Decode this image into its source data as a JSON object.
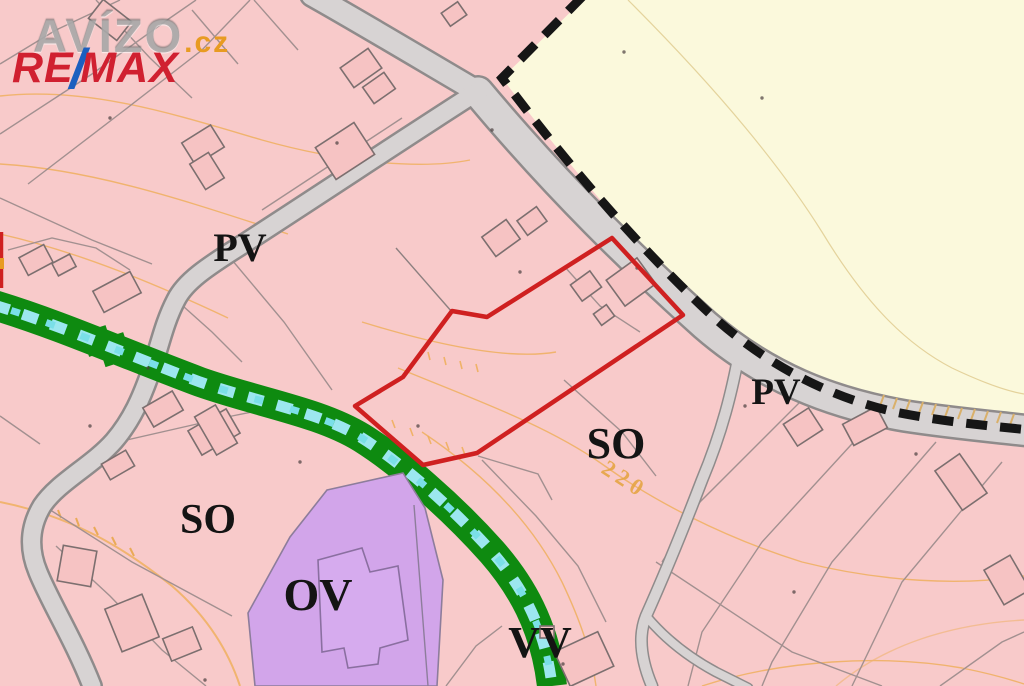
{
  "branding": {
    "watermark_text": "AVÍZO",
    "watermark_suffix": ".cz",
    "remax_re": "RE",
    "remax_slash": "/",
    "remax_max": "MAX"
  },
  "map": {
    "zone_labels": [
      {
        "id": "pv-upper-left",
        "text": "PV"
      },
      {
        "id": "pv-right",
        "text": "PV"
      },
      {
        "id": "so-left",
        "text": "SO"
      },
      {
        "id": "so-center",
        "text": "SO"
      },
      {
        "id": "ov",
        "text": "OV"
      },
      {
        "id": "vv",
        "text": "VV"
      }
    ],
    "contour_elevation_label": "220",
    "zone_types_visible": [
      "PV",
      "SO",
      "OV",
      "VV"
    ],
    "colors": {
      "residential_pink": "#f8caca",
      "open_landscape_yellow": "#fbf9dc",
      "civic_purple": "#d2a5ea",
      "greenway_green": "#0e8a10",
      "water_dash_cyan": "#9ce7ef",
      "road_fill": "#d7d3d3",
      "road_edge": "#8f8b8b",
      "parcel_line": "#a29090",
      "contour_orange": "#efae58",
      "highlight_red": "#cf2020",
      "boundary_dash_black": "#161616"
    }
  }
}
